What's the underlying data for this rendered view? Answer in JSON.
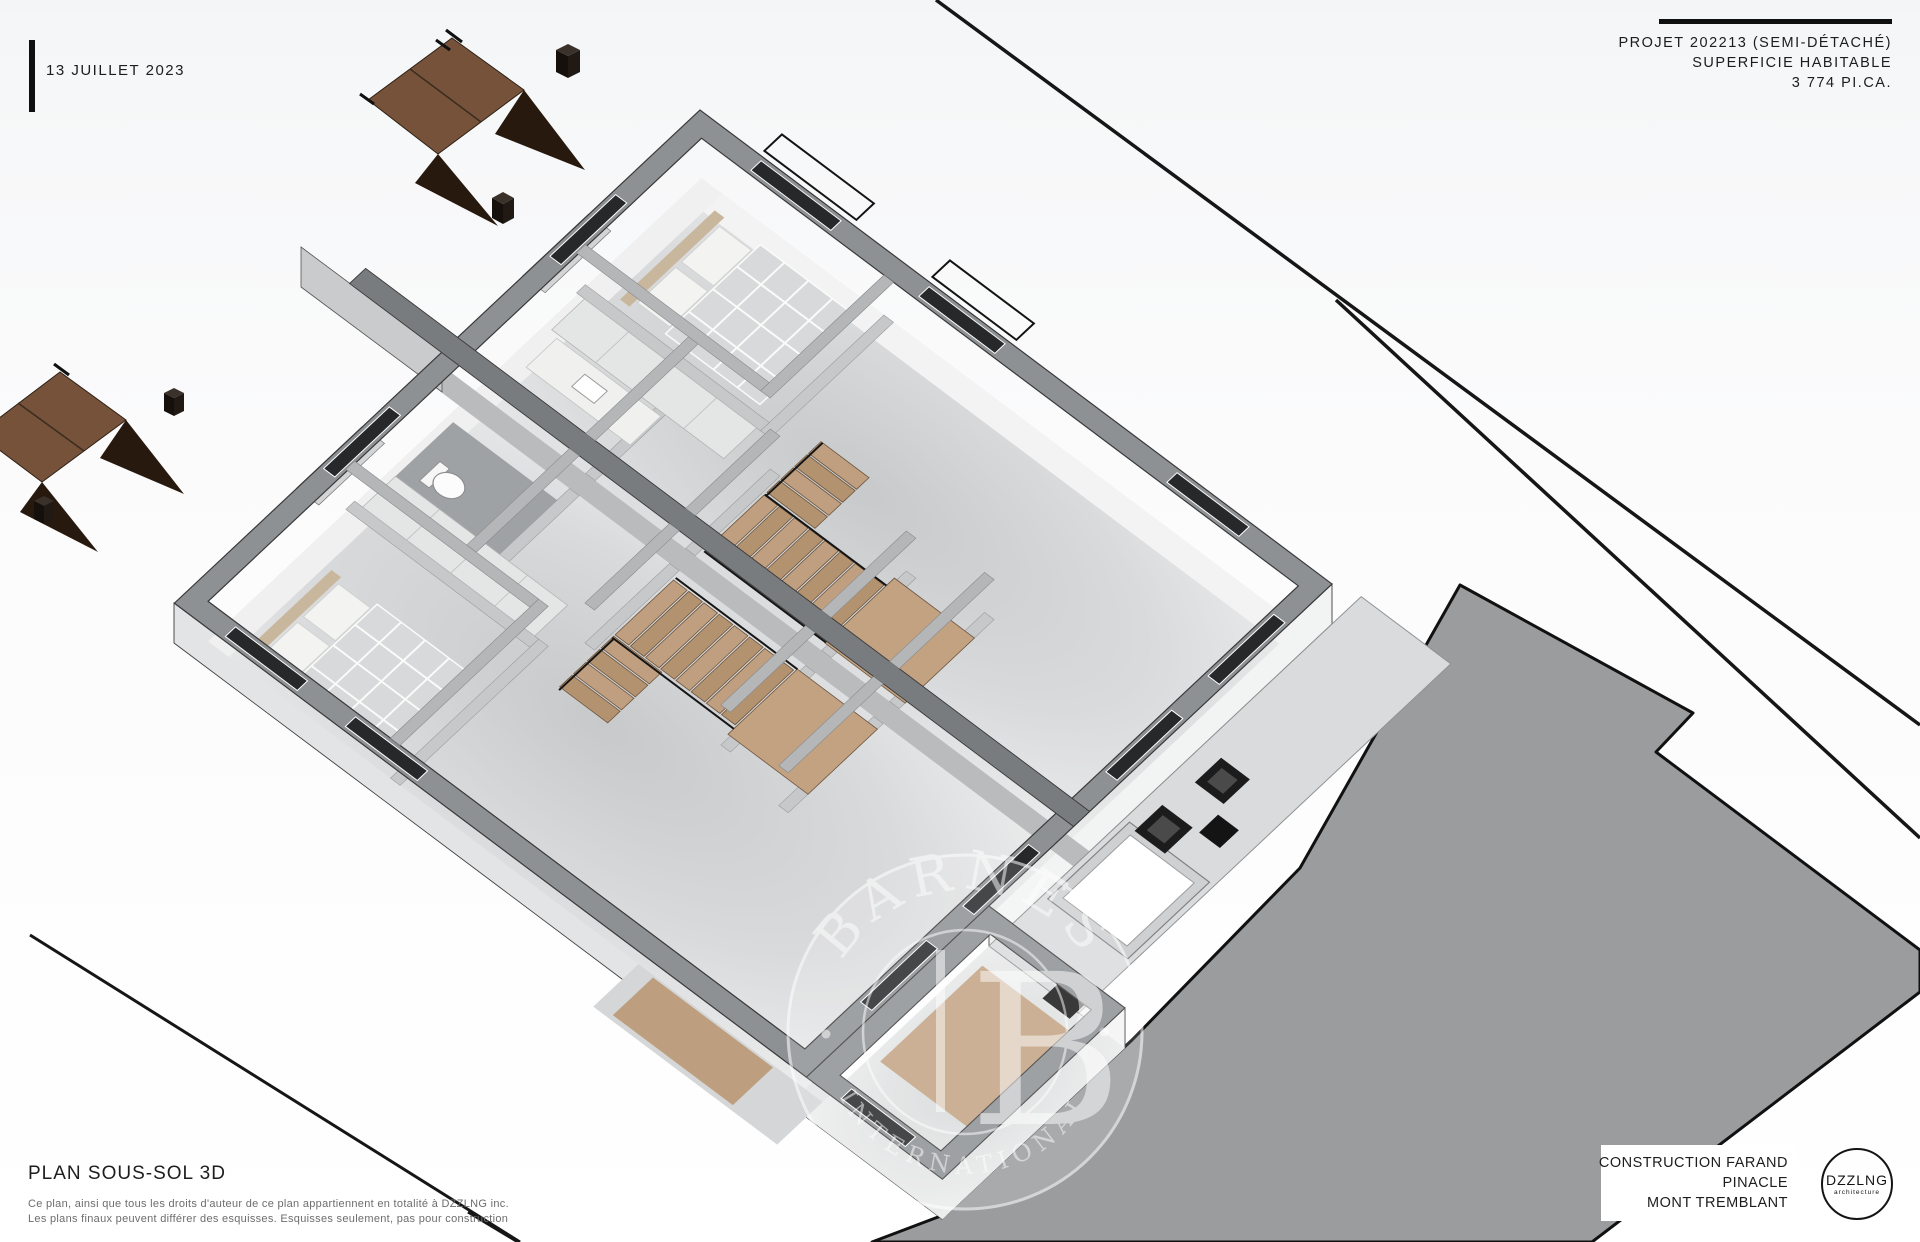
{
  "header": {
    "date": "13 JUILLET 2023",
    "project_line1": "PROJET 202213 (SEMI-DÉTACHÉ)",
    "project_line2": "SUPERFICIE HABITABLE",
    "project_line3": "3 774 PI.CA."
  },
  "footer": {
    "plan_title": "PLAN SOUS-SOL 3D",
    "disclaimer_line1": "Ce plan, ainsi que tous les droits d'auteur de ce plan appartiennent en totalité à DZZLNG inc.",
    "disclaimer_line2": "Les plans finaux peuvent différer des esquisses. Esquisses seulement, pas pour construction",
    "builder": "CONSTRUCTION FARAND",
    "development": "PINACLE",
    "city": "MONT TREMBLANT"
  },
  "logo": {
    "name": "DZZLNG",
    "subtitle": "architecture"
  },
  "watermark": {
    "brand": "BARNES",
    "subtitle": "INTERNATIONAL",
    "monogram": "B"
  },
  "colors": {
    "wall_top": "#8e9194",
    "wall_face_light": "#f2f3f3",
    "floor_light": "#e9eaeb",
    "driveway_gray": "#9a9c9e",
    "wood_stair": "#b99877",
    "exterior_wood": "#76523a",
    "ink": "#1a1a1a"
  }
}
